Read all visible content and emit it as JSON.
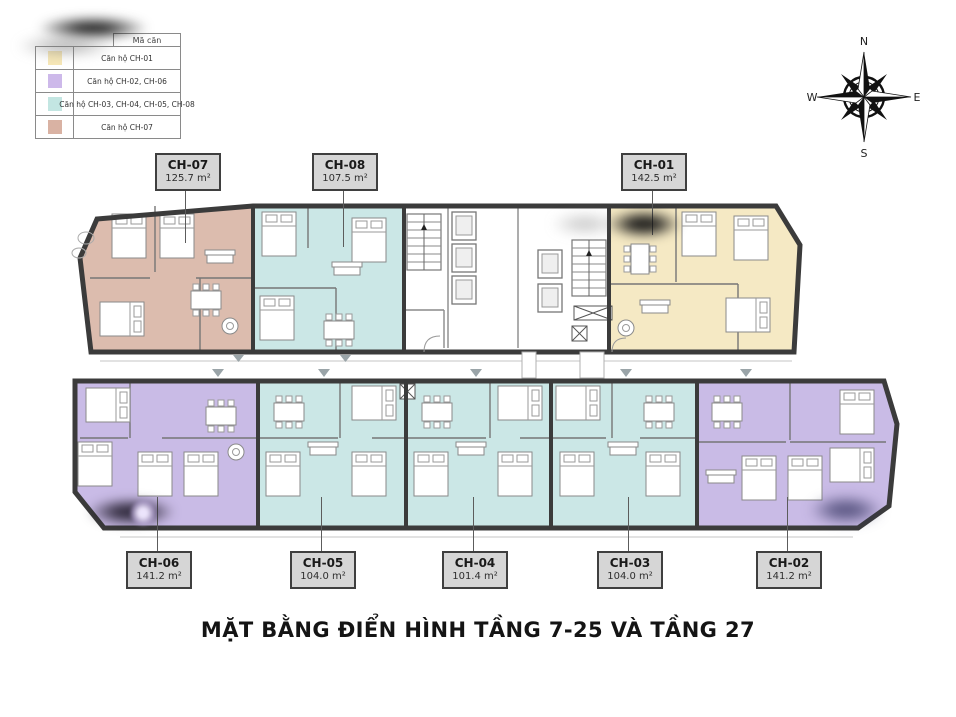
{
  "title": "MẶT BẰNG ĐIỂN HÌNH TẦNG 7-25 VÀ TẦNG 27",
  "legend": {
    "header": "Mã căn",
    "items": [
      {
        "label": "Căn hộ CH-01",
        "color": "#f7e8b8"
      },
      {
        "label": "Căn hộ CH-02, CH-06",
        "color": "#cdb9ea"
      },
      {
        "label": "Căn hộ CH-03, CH-04, CH-05, CH-08",
        "color": "#c3e6e2"
      },
      {
        "label": "Căn hộ CH-07",
        "color": "#d9b2a3"
      }
    ]
  },
  "compass": {
    "north": "N",
    "east": "E",
    "south": "S",
    "west": "W"
  },
  "units": {
    "top": [
      {
        "code": "CH-07",
        "area": "125.7 m²"
      },
      {
        "code": "CH-08",
        "area": "107.5 m²"
      },
      {
        "code": "CH-01",
        "area": "142.5 m²"
      }
    ],
    "bottom": [
      {
        "code": "CH-06",
        "area": "141.2 m²"
      },
      {
        "code": "CH-05",
        "area": "104.0 m²"
      },
      {
        "code": "CH-04",
        "area": "101.4 m²"
      },
      {
        "code": "CH-03",
        "area": "104.0 m²"
      },
      {
        "code": "CH-02",
        "area": "141.2 m²"
      }
    ]
  },
  "colors": {
    "wall": "#3b3b3b",
    "unit_ch01": "#f5e9c4",
    "unit_ch02_ch06": "#c9bbe6",
    "unit_ch03_04_05_08": "#cbe7e6",
    "unit_ch07": "#dcbcae",
    "core": "#ffffff"
  }
}
